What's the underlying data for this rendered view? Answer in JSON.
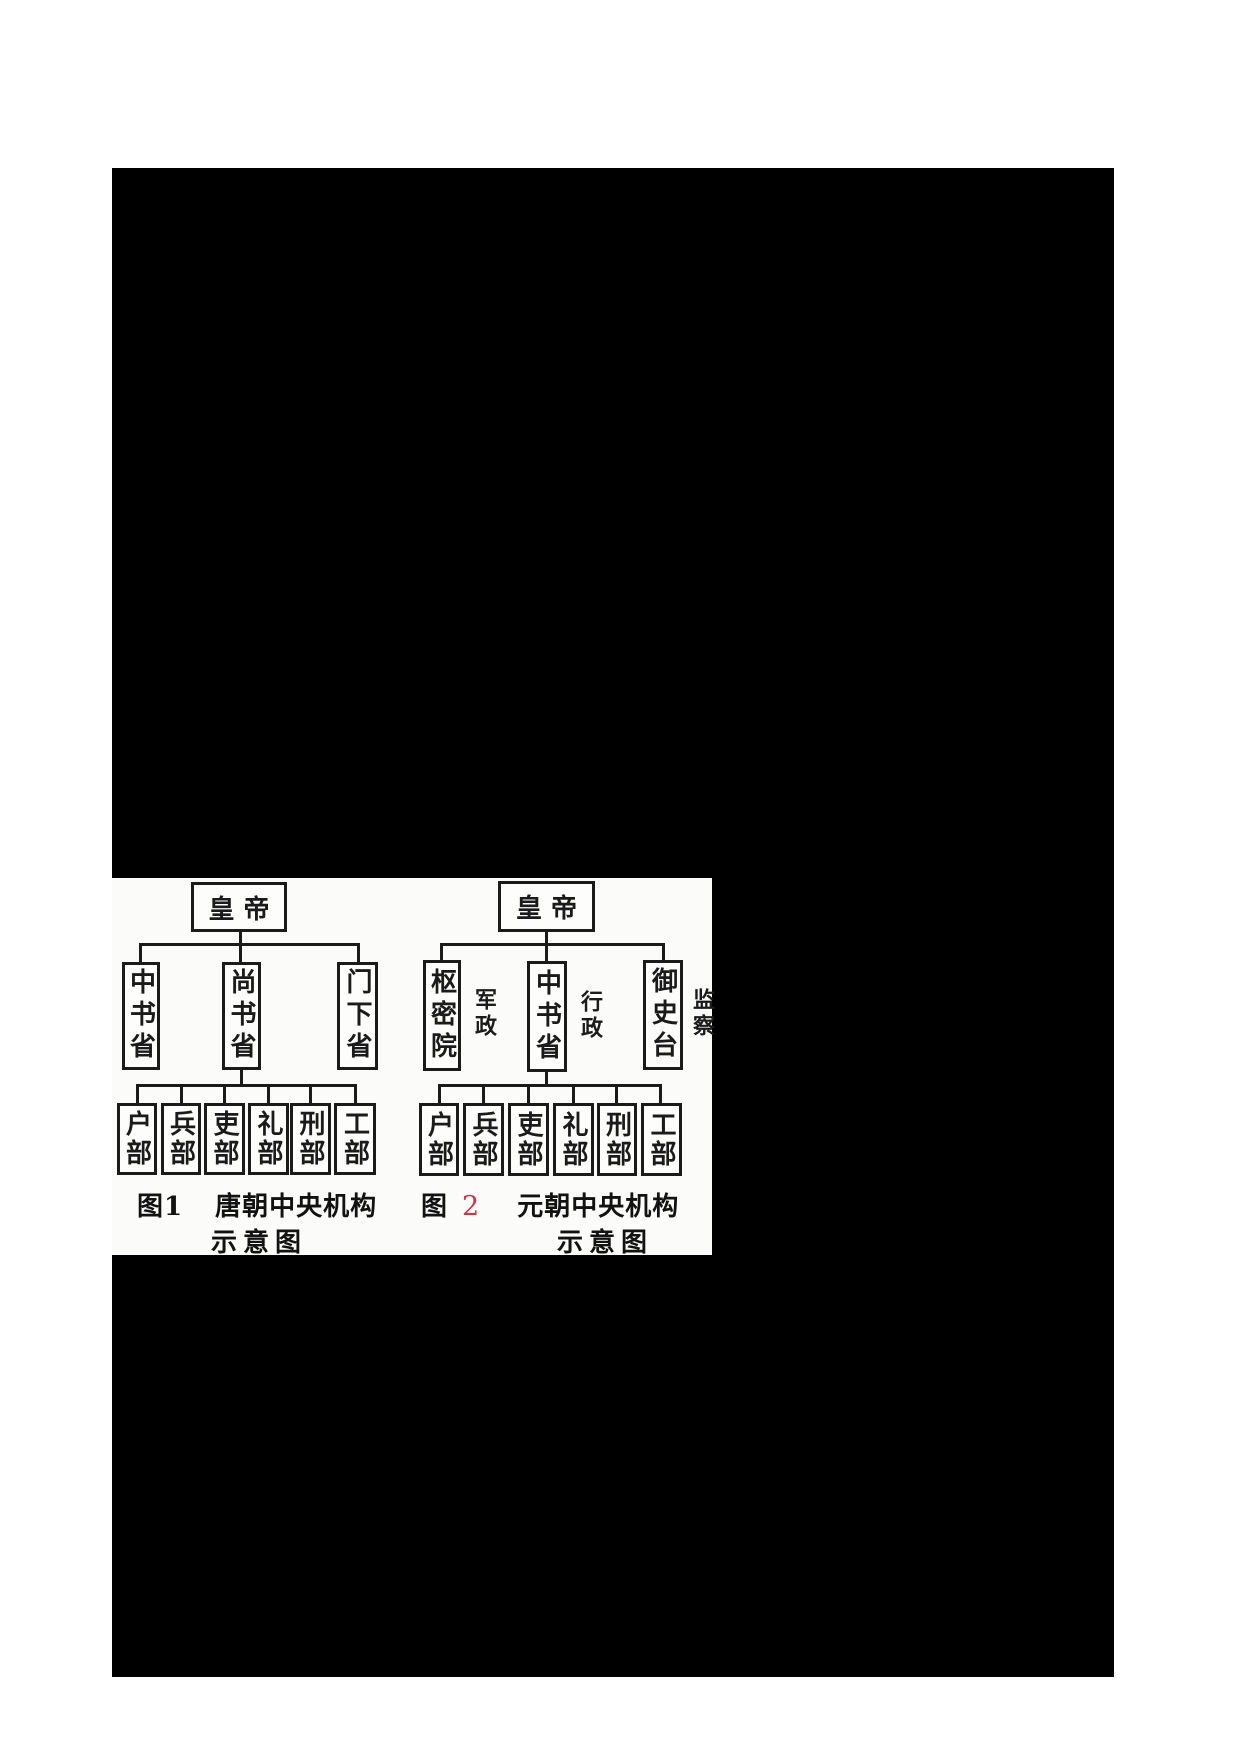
{
  "colors": {
    "scan_background": "#000000",
    "diagram_paper": "#fbfbf9",
    "ink": "#1b1b1b",
    "figure2_number_red": "#c6394a"
  },
  "figure1": {
    "emperor": "皇帝",
    "level2": [
      {
        "name": "中书省"
      },
      {
        "name": "尚书省"
      },
      {
        "name": "门下省"
      }
    ],
    "ministries": [
      "户部",
      "兵部",
      "吏部",
      "礼部",
      "刑部",
      "工部"
    ],
    "caption": {
      "label": "图1",
      "title": "唐朝中央机构",
      "subtitle": "示意图"
    }
  },
  "figure2": {
    "emperor": "皇帝",
    "level2": [
      {
        "name": "枢密院",
        "role": "军政"
      },
      {
        "name": "中书省",
        "role": "行政"
      },
      {
        "name": "御史台",
        "role": "监察"
      }
    ],
    "ministries": [
      "户部",
      "兵部",
      "吏部",
      "礼部",
      "刑部",
      "工部"
    ],
    "caption": {
      "label": "图",
      "number": "2",
      "title": "元朝中央机构",
      "subtitle": "示意图"
    }
  }
}
